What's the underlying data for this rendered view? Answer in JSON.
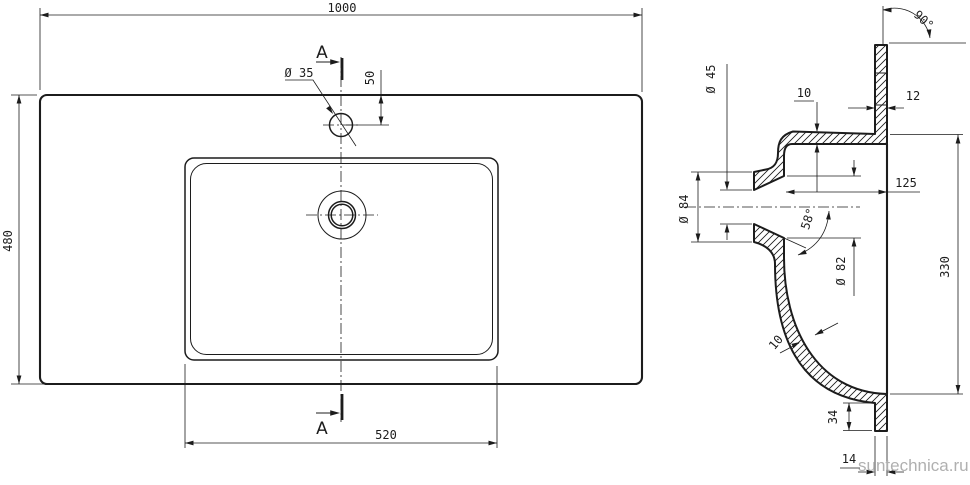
{
  "watermark": "suntechnica.ru",
  "plan_view": {
    "section_label": "A",
    "dim_overall_width": "1000",
    "dim_overall_depth": "480",
    "dim_basin_width": "520",
    "dim_faucet_hole_dia": "Ø 35",
    "dim_faucet_hole_offset": "50"
  },
  "section_view": {
    "dim_corner_angle": "90°",
    "dim_top_thickness": "10",
    "dim_edge_thickness": "12",
    "dim_drain_bore_dia": "Ø 45",
    "dim_drain_boss_dia": "Ø 84",
    "dim_drain_to_back": "125",
    "dim_drain_taper_angle": "58°",
    "dim_drain_opening_dia": "Ø 82",
    "dim_overall_height": "330",
    "dim_shell_thickness": "10",
    "dim_foot_height": "34",
    "dim_foot_width": "14"
  },
  "colors": {
    "line": "#1c1c1c",
    "watermark": "#b0b0b0",
    "background": "#ffffff"
  }
}
